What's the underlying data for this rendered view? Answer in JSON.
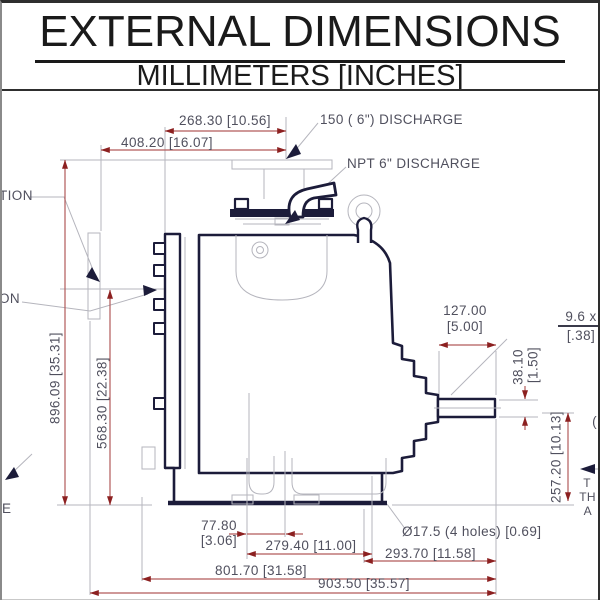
{
  "header": {
    "title": "EXTERNAL DIMENSIONS",
    "subtitle": "MILLIMETERS [INCHES]"
  },
  "callouts": {
    "discharge_flange": "150 ( 6\") DISCHARGE",
    "discharge_npt": "NPT 6\" DISCHARGE",
    "suction_fragment_top": "TION",
    "suction_fragment_bottom": "ON",
    "left_edge_fragment": "E",
    "right_edge_paren": "(",
    "right_edge_line1": "T",
    "right_edge_line2": "TH",
    "right_edge_line3": "A",
    "bolt_holes": "Ø17.5 (4 holes) [0.69]"
  },
  "dimensions": {
    "discharge_to_suction_face": "268.30 [10.56]",
    "discharge_to_flange_face": "408.20 [16.07]",
    "overall_height": "896.09 [35.31]",
    "suction_centerline_height": "568.30 [22.38]",
    "shaft_extension": {
      "mm": "127.00",
      "in": "[5.00]"
    },
    "keyway": {
      "mm": "9.6 x",
      "in": "[.38]"
    },
    "shaft_diameter": {
      "mm": "38.10",
      "in": "[1.50]"
    },
    "shaft_centerline_height": "257.20 [10.13]",
    "front_foot": {
      "mm": "77.80",
      "in": "[3.06]"
    },
    "foot_spacing": "279.40 [11.00]",
    "bearing_overhang": "293.70 [11.58]",
    "body_length": "801.70 [31.58]",
    "overall_length": "903.50 [35.57]"
  },
  "colors": {
    "dimension_line": "#b25b5b",
    "arrowhead": "#8c2020",
    "outline": "#1c1c3a",
    "construction": "#b5b5bd",
    "dimension_text": "#50505e"
  }
}
